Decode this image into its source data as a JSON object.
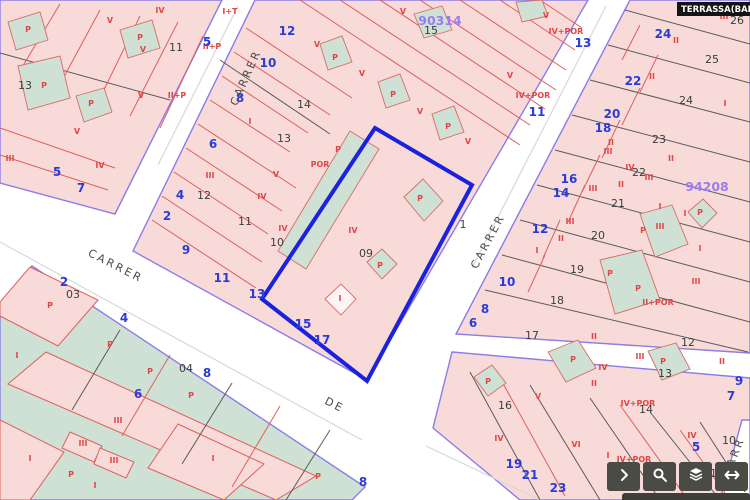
{
  "header": {
    "municipality_label": "TERRASSA(BARCEL"
  },
  "map": {
    "colors": {
      "parcel_pink": "#f8dbd9",
      "building_green": "#cfe1d5",
      "street_edge_purple": "#8b7ce8",
      "selected_parcel_blue": "#1b22dd",
      "subparcel_red_line": "#dd5f5c",
      "parcel_black_line": "#5a5a5a",
      "street_number_blue": "#2a3cd6",
      "parcel_number_black": "#3d3d3d",
      "construction_label_red": "#e04646",
      "block_id_purple": "#9b7bf0"
    },
    "selected_parcel_number": "09",
    "block_ids": [
      {
        "t": "90314",
        "x": 440,
        "y": 25
      },
      {
        "t": "94208",
        "x": 707,
        "y": 191
      }
    ],
    "street_names": [
      {
        "t": "CARRER",
        "x": 249,
        "y": 79,
        "rot": -66
      },
      {
        "t": "CARRER",
        "x": 114,
        "y": 269,
        "rot": 27
      },
      {
        "t": "CARRER",
        "x": 491,
        "y": 243,
        "rot": -62
      },
      {
        "t": "DE",
        "x": 333,
        "y": 408,
        "rot": 27
      },
      {
        "t": "CARR",
        "x": 737,
        "y": 458,
        "rot": -68
      }
    ],
    "street_numbers": [
      {
        "t": "5",
        "x": 207,
        "y": 46
      },
      {
        "t": "12",
        "x": 287,
        "y": 35
      },
      {
        "t": "10",
        "x": 268,
        "y": 67
      },
      {
        "t": "8",
        "x": 240,
        "y": 102
      },
      {
        "t": "6",
        "x": 213,
        "y": 148
      },
      {
        "t": "4",
        "x": 180,
        "y": 199
      },
      {
        "t": "2",
        "x": 167,
        "y": 220
      },
      {
        "t": "5",
        "x": 57,
        "y": 176
      },
      {
        "t": "7",
        "x": 81,
        "y": 192
      },
      {
        "t": "9",
        "x": 186,
        "y": 254
      },
      {
        "t": "11",
        "x": 222,
        "y": 282
      },
      {
        "t": "13",
        "x": 257,
        "y": 298
      },
      {
        "t": "15",
        "x": 303,
        "y": 328
      },
      {
        "t": "17",
        "x": 322,
        "y": 344
      },
      {
        "t": "13",
        "x": 583,
        "y": 47
      },
      {
        "t": "11",
        "x": 537,
        "y": 116
      },
      {
        "t": "24",
        "x": 663,
        "y": 38
      },
      {
        "t": "22",
        "x": 633,
        "y": 85
      },
      {
        "t": "20",
        "x": 612,
        "y": 118
      },
      {
        "t": "18",
        "x": 603,
        "y": 132
      },
      {
        "t": "16",
        "x": 569,
        "y": 183
      },
      {
        "t": "14",
        "x": 561,
        "y": 197
      },
      {
        "t": "12",
        "x": 540,
        "y": 233
      },
      {
        "t": "10",
        "x": 507,
        "y": 286
      },
      {
        "t": "8",
        "x": 485,
        "y": 313
      },
      {
        "t": "6",
        "x": 473,
        "y": 327
      },
      {
        "t": "19",
        "x": 514,
        "y": 468
      },
      {
        "t": "21",
        "x": 530,
        "y": 479
      },
      {
        "t": "23",
        "x": 558,
        "y": 492
      },
      {
        "t": "9",
        "x": 739,
        "y": 385
      },
      {
        "t": "7",
        "x": 731,
        "y": 400
      },
      {
        "t": "5",
        "x": 696,
        "y": 451
      },
      {
        "t": "2",
        "x": 64,
        "y": 286
      },
      {
        "t": "4",
        "x": 124,
        "y": 322
      },
      {
        "t": "6",
        "x": 138,
        "y": 398
      },
      {
        "t": "8",
        "x": 207,
        "y": 377
      },
      {
        "t": "8",
        "x": 363,
        "y": 486
      }
    ],
    "parcel_numbers": [
      {
        "t": "11",
        "x": 176,
        "y": 51
      },
      {
        "t": "13",
        "x": 25,
        "y": 89
      },
      {
        "t": "15",
        "x": 431,
        "y": 34
      },
      {
        "t": "14",
        "x": 304,
        "y": 108
      },
      {
        "t": "13",
        "x": 284,
        "y": 142
      },
      {
        "t": "12",
        "x": 204,
        "y": 199
      },
      {
        "t": "11",
        "x": 245,
        "y": 225
      },
      {
        "t": "10",
        "x": 277,
        "y": 246
      },
      {
        "t": "09",
        "x": 366,
        "y": 257
      },
      {
        "t": "1",
        "x": 463,
        "y": 228
      },
      {
        "t": "26",
        "x": 737,
        "y": 24
      },
      {
        "t": "25",
        "x": 712,
        "y": 63
      },
      {
        "t": "24",
        "x": 686,
        "y": 104
      },
      {
        "t": "23",
        "x": 659,
        "y": 143
      },
      {
        "t": "22",
        "x": 639,
        "y": 176
      },
      {
        "t": "21",
        "x": 618,
        "y": 207
      },
      {
        "t": "20",
        "x": 598,
        "y": 239
      },
      {
        "t": "19",
        "x": 577,
        "y": 273
      },
      {
        "t": "18",
        "x": 557,
        "y": 304
      },
      {
        "t": "17",
        "x": 532,
        "y": 339
      },
      {
        "t": "12",
        "x": 688,
        "y": 346
      },
      {
        "t": "13",
        "x": 665,
        "y": 377
      },
      {
        "t": "14",
        "x": 646,
        "y": 413
      },
      {
        "t": "16",
        "x": 505,
        "y": 409
      },
      {
        "t": "10",
        "x": 729,
        "y": 444
      },
      {
        "t": "11",
        "x": 710,
        "y": 477
      },
      {
        "t": "03",
        "x": 73,
        "y": 298
      },
      {
        "t": "04",
        "x": 186,
        "y": 372
      }
    ],
    "construction_labels": [
      {
        "t": "IV",
        "x": 160,
        "y": 13
      },
      {
        "t": "V",
        "x": 110,
        "y": 23
      },
      {
        "t": "P",
        "x": 28,
        "y": 32
      },
      {
        "t": "P",
        "x": 140,
        "y": 40
      },
      {
        "t": "V",
        "x": 143,
        "y": 52
      },
      {
        "t": "V",
        "x": 141,
        "y": 98
      },
      {
        "t": "P",
        "x": 44,
        "y": 88
      },
      {
        "t": "P",
        "x": 91,
        "y": 106
      },
      {
        "t": "V",
        "x": 77,
        "y": 134
      },
      {
        "t": "IV",
        "x": 100,
        "y": 168
      },
      {
        "t": "III",
        "x": 10,
        "y": 161
      },
      {
        "t": "I+T",
        "x": 230,
        "y": 14
      },
      {
        "t": "II+P",
        "x": 212,
        "y": 49
      },
      {
        "t": "II+P",
        "x": 177,
        "y": 98
      },
      {
        "t": "V",
        "x": 403,
        "y": 14
      },
      {
        "t": "V",
        "x": 317,
        "y": 47
      },
      {
        "t": "P",
        "x": 335,
        "y": 60
      },
      {
        "t": "V",
        "x": 362,
        "y": 76
      },
      {
        "t": "P",
        "x": 393,
        "y": 97
      },
      {
        "t": "V",
        "x": 420,
        "y": 114
      },
      {
        "t": "P",
        "x": 448,
        "y": 129
      },
      {
        "t": "V",
        "x": 468,
        "y": 144
      },
      {
        "t": "V",
        "x": 546,
        "y": 18
      },
      {
        "t": "IV+POR",
        "x": 566,
        "y": 34
      },
      {
        "t": "V",
        "x": 510,
        "y": 78
      },
      {
        "t": "IV+POR",
        "x": 533,
        "y": 98
      },
      {
        "t": "I",
        "x": 250,
        "y": 124
      },
      {
        "t": "POR",
        "x": 320,
        "y": 167
      },
      {
        "t": "III",
        "x": 210,
        "y": 178
      },
      {
        "t": "V",
        "x": 276,
        "y": 177
      },
      {
        "t": "IV",
        "x": 262,
        "y": 199
      },
      {
        "t": "IV",
        "x": 283,
        "y": 231
      },
      {
        "t": "IV",
        "x": 353,
        "y": 233
      },
      {
        "t": "P",
        "x": 338,
        "y": 152
      },
      {
        "t": "P",
        "x": 420,
        "y": 201
      },
      {
        "t": "P",
        "x": 380,
        "y": 268
      },
      {
        "t": "I",
        "x": 340,
        "y": 301
      },
      {
        "t": "III",
        "x": 724,
        "y": 19
      },
      {
        "t": "II",
        "x": 676,
        "y": 43
      },
      {
        "t": "II",
        "x": 652,
        "y": 79
      },
      {
        "t": "I",
        "x": 725,
        "y": 106
      },
      {
        "t": "II",
        "x": 611,
        "y": 145
      },
      {
        "t": "III",
        "x": 608,
        "y": 154
      },
      {
        "t": "IV",
        "x": 630,
        "y": 170
      },
      {
        "t": "III",
        "x": 649,
        "y": 180
      },
      {
        "t": "III",
        "x": 593,
        "y": 191
      },
      {
        "t": "II",
        "x": 671,
        "y": 161
      },
      {
        "t": "II",
        "x": 621,
        "y": 187
      },
      {
        "t": "III",
        "x": 570,
        "y": 224
      },
      {
        "t": "II",
        "x": 561,
        "y": 241
      },
      {
        "t": "I",
        "x": 537,
        "y": 253
      },
      {
        "t": "I",
        "x": 660,
        "y": 209
      },
      {
        "t": "I",
        "x": 685,
        "y": 216
      },
      {
        "t": "III",
        "x": 660,
        "y": 229
      },
      {
        "t": "P",
        "x": 700,
        "y": 215
      },
      {
        "t": "P",
        "x": 643,
        "y": 233
      },
      {
        "t": "P",
        "x": 610,
        "y": 276
      },
      {
        "t": "P",
        "x": 638,
        "y": 291
      },
      {
        "t": "II+POR",
        "x": 658,
        "y": 305
      },
      {
        "t": "I",
        "x": 700,
        "y": 251
      },
      {
        "t": "III",
        "x": 696,
        "y": 284
      },
      {
        "t": "II",
        "x": 594,
        "y": 339
      },
      {
        "t": "III",
        "x": 640,
        "y": 359
      },
      {
        "t": "II",
        "x": 722,
        "y": 364
      },
      {
        "t": "IV",
        "x": 603,
        "y": 370
      },
      {
        "t": "II",
        "x": 594,
        "y": 386
      },
      {
        "t": "IV+POR",
        "x": 638,
        "y": 406
      },
      {
        "t": "V",
        "x": 538,
        "y": 399
      },
      {
        "t": "VI",
        "x": 576,
        "y": 447
      },
      {
        "t": "I",
        "x": 608,
        "y": 458
      },
      {
        "t": "IV",
        "x": 692,
        "y": 438
      },
      {
        "t": "IV+POR",
        "x": 634,
        "y": 462
      },
      {
        "t": "P",
        "x": 573,
        "y": 362
      },
      {
        "t": "P",
        "x": 663,
        "y": 364
      },
      {
        "t": "P",
        "x": 488,
        "y": 384
      },
      {
        "t": "IV",
        "x": 499,
        "y": 441
      },
      {
        "t": "I",
        "x": 17,
        "y": 358
      },
      {
        "t": "P",
        "x": 110,
        "y": 347
      },
      {
        "t": "P",
        "x": 150,
        "y": 374
      },
      {
        "t": "P",
        "x": 191,
        "y": 398
      },
      {
        "t": "P",
        "x": 50,
        "y": 308
      },
      {
        "t": "III",
        "x": 118,
        "y": 423
      },
      {
        "t": "III",
        "x": 83,
        "y": 446
      },
      {
        "t": "III",
        "x": 114,
        "y": 463
      },
      {
        "t": "I",
        "x": 30,
        "y": 461
      },
      {
        "t": "I",
        "x": 213,
        "y": 461
      },
      {
        "t": "P",
        "x": 71,
        "y": 477
      },
      {
        "t": "I",
        "x": 95,
        "y": 488
      },
      {
        "t": "P",
        "x": 318,
        "y": 479
      }
    ]
  },
  "toolbar": {
    "buttons": [
      {
        "name": "expand",
        "icon": "chevron-right"
      },
      {
        "name": "search",
        "icon": "magnifier"
      },
      {
        "name": "layers",
        "icon": "layers"
      },
      {
        "name": "pan-horizontal",
        "icon": "arrows-horizontal"
      }
    ]
  }
}
